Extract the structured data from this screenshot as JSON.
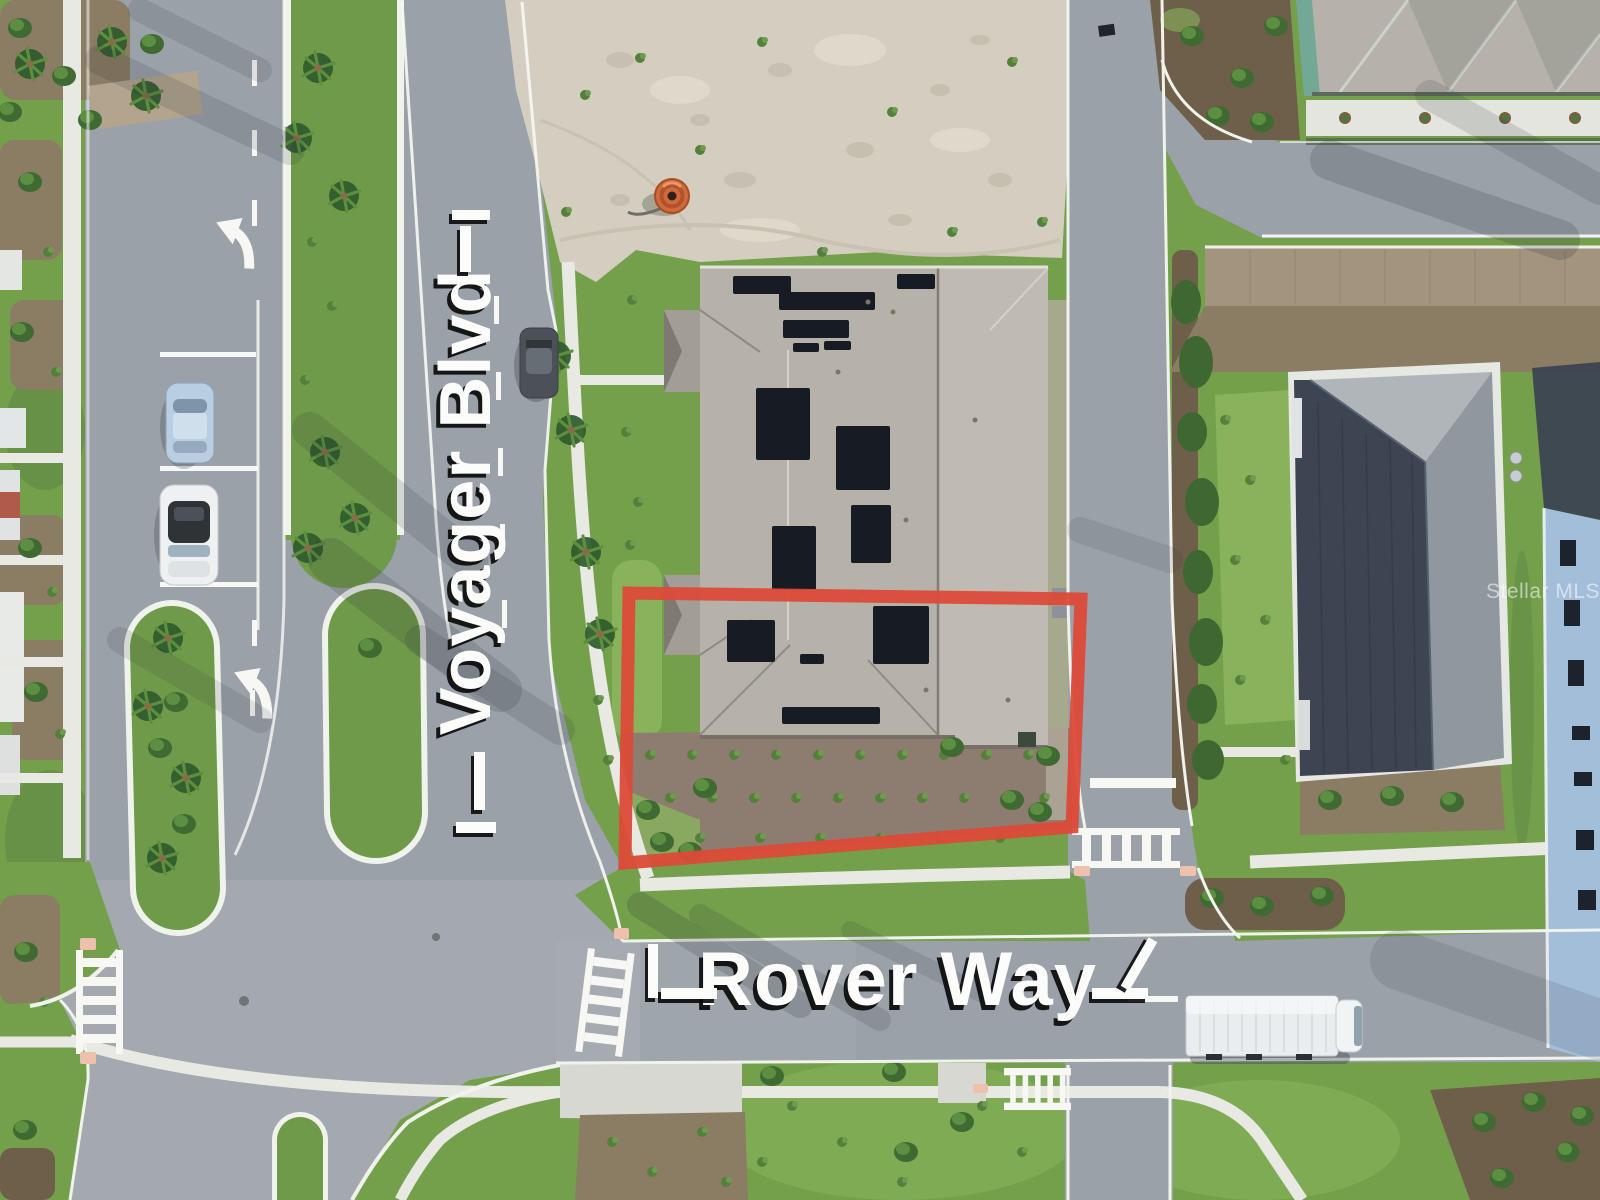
{
  "labels": {
    "street_vertical": "Voyager Blvd",
    "street_horizontal": "Rover Way",
    "watermark": "Stellar MLS"
  },
  "colors": {
    "road": "#9aa1a8",
    "grass": "#74a04c",
    "grassBright": "#88b35c",
    "grassDark": "#5a8140",
    "sand": "#d4cec0",
    "sidewalk": "#e8e9e2",
    "curb": "#f0f2ec",
    "marking": "#f7f8f4",
    "mulch": "#8b7c64",
    "mulchDark": "#6e5f4b",
    "subjectBed": "#8d7d70",
    "roofShingle": "#b6b2a9",
    "roofLight": "#c4c0b7",
    "roofDark": "#3c4551",
    "roofConcrete": "#b0b5ba",
    "roofFacet": "#8f989f",
    "solar": "#171b24",
    "outlineRed": "#dc4a38",
    "salmon": "#eec0ae",
    "hedge": "#3e6732",
    "paver": "#a3947e",
    "teal": "#74a896",
    "blueWall": "#a2bed9",
    "carBlue": "#b9cfe1",
    "carDark": "#4b5157",
    "truck": "#e9edef",
    "barrel": "#cf6a3d"
  }
}
